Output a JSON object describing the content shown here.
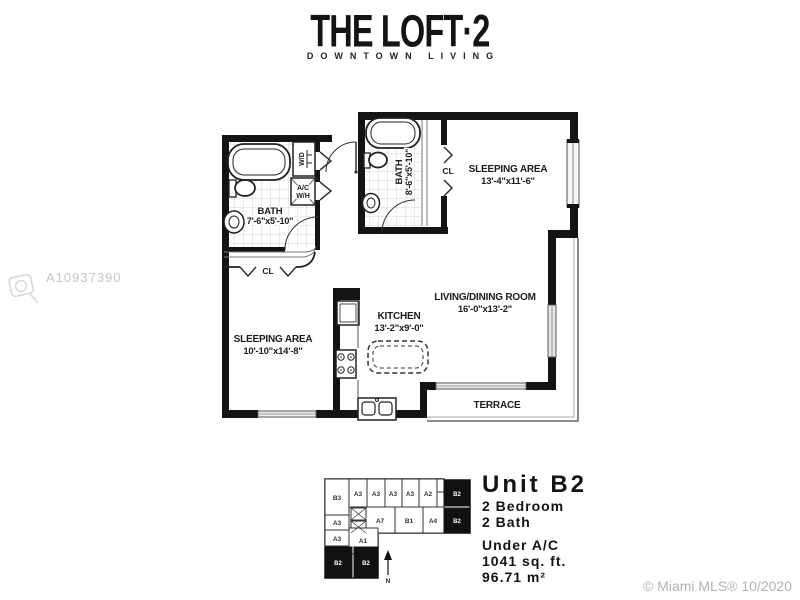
{
  "logo": {
    "title": "THE LOFT·2",
    "subtitle": "DOWNTOWN LIVING"
  },
  "colors": {
    "wall": "#141414",
    "watermark_gray": "#c6c6c6",
    "copyright_gray": "#b2b2b2"
  },
  "floorplan": {
    "rooms": {
      "sleeping_top": {
        "name": "SLEEPING AREA",
        "dims": "13'-4\"x11'-6\""
      },
      "bath_left": {
        "name": "BATH",
        "dims": "7'-6\"x5'-10\""
      },
      "bath_top": {
        "name": "BATH",
        "dims": "8'-6\"x5'-10\""
      },
      "living": {
        "name": "LIVING/DINING ROOM",
        "dims": "16'-0\"x13'-2\""
      },
      "kitchen": {
        "name": "KITCHEN",
        "dims": "13'-2\"x9'-0\""
      },
      "sleeping_left": {
        "name": "SLEEPING AREA",
        "dims": "10'-10\"x14'-8\""
      },
      "terrace": {
        "name": "TERRACE"
      }
    },
    "labels": {
      "closet_left": "CL",
      "closet_top": "CL",
      "washer_dryer": "W/D",
      "ac": "A/C",
      "water_heater": "W/H"
    }
  },
  "keyplan": {
    "north": "N",
    "units": [
      {
        "label": "B3",
        "highlighted": false
      },
      {
        "label": "A3",
        "highlighted": false
      },
      {
        "label": "A3",
        "highlighted": false
      },
      {
        "label": "A3",
        "highlighted": false
      },
      {
        "label": "A3",
        "highlighted": false
      },
      {
        "label": "A2",
        "highlighted": false
      },
      {
        "label": "B2",
        "highlighted": true
      },
      {
        "label": "A3",
        "highlighted": false
      },
      {
        "label": "A7",
        "highlighted": false
      },
      {
        "label": "B1",
        "highlighted": false
      },
      {
        "label": "A4",
        "highlighted": false
      },
      {
        "label": "B2",
        "highlighted": true
      },
      {
        "label": "A3",
        "highlighted": false
      },
      {
        "label": "A1",
        "highlighted": false
      },
      {
        "label": "B2",
        "highlighted": true
      },
      {
        "label": "B2",
        "highlighted": true
      }
    ]
  },
  "unit_info": {
    "title": "Unit B2",
    "bedrooms": "2 Bedroom",
    "baths": "2 Bath",
    "ac_label": "Under A/C",
    "sqft": "1041 sq. ft.",
    "sqm": "96.71 m²"
  },
  "watermarks": {
    "mls_id": "A10937390",
    "copyright": "© Miami MLS® 10/2020"
  }
}
